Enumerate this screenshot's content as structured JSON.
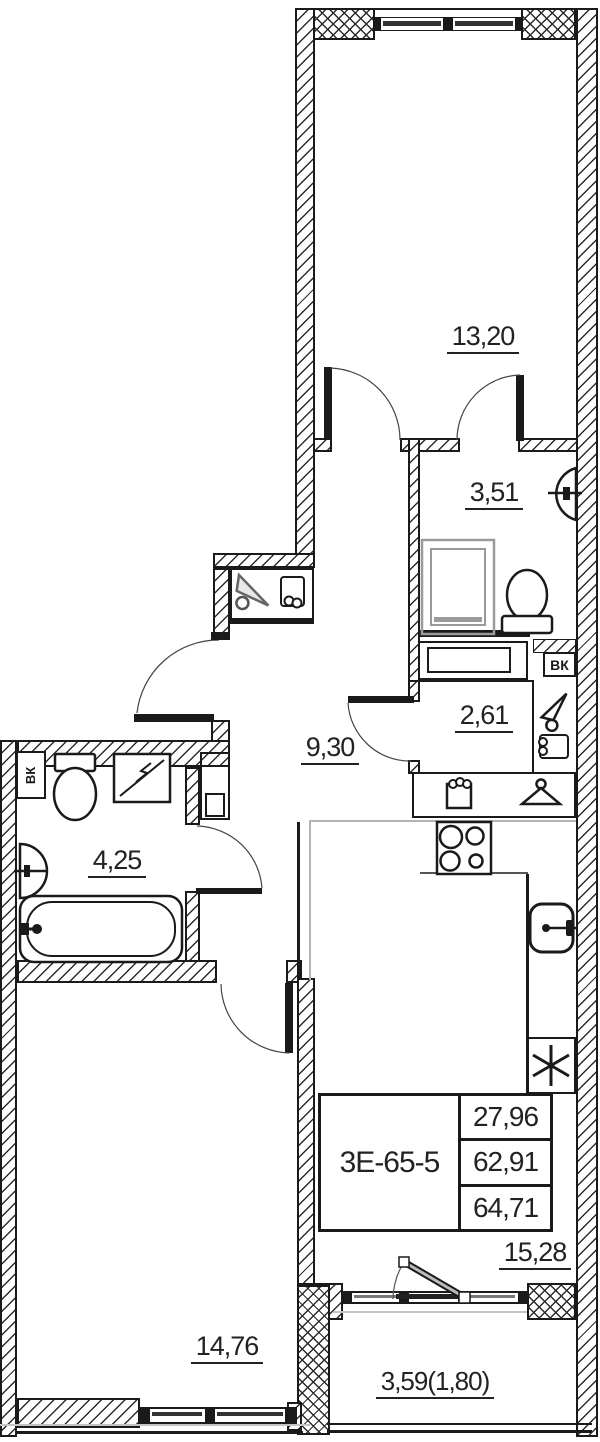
{
  "floor_plan": {
    "unit": {
      "code": "3Е-65-5",
      "area_values": [
        "27,96",
        "62,91",
        "64,71"
      ]
    },
    "rooms": {
      "room_top": {
        "area": "13,20"
      },
      "bathroom_top": {
        "area": "3,51"
      },
      "storage": {
        "area": "2,61"
      },
      "hallway": {
        "area": "9,30"
      },
      "bathroom_left": {
        "area": "4,25"
      },
      "room_bottom": {
        "area": "14,76"
      },
      "kitchen_living": {
        "area": "15,28"
      },
      "balcony": {
        "area": "3,59(1,80)"
      }
    },
    "shafts": {
      "vent_label": "ВК"
    },
    "colors": {
      "line": "#1a1a1a",
      "zone_line": "#b3b3b3",
      "fixture_gray": "#9a9a9a"
    },
    "icons": [
      "toilet-icon",
      "sink-icon",
      "shower-icon",
      "bathtub-icon",
      "washing-machine-icon",
      "stove-icon",
      "kitchen-sink-icon",
      "fridge-icon",
      "coat-hanger-icon",
      "wall-hook-icon",
      "mitten-icon",
      "glove-box-icon",
      "door-swing-arc"
    ]
  }
}
